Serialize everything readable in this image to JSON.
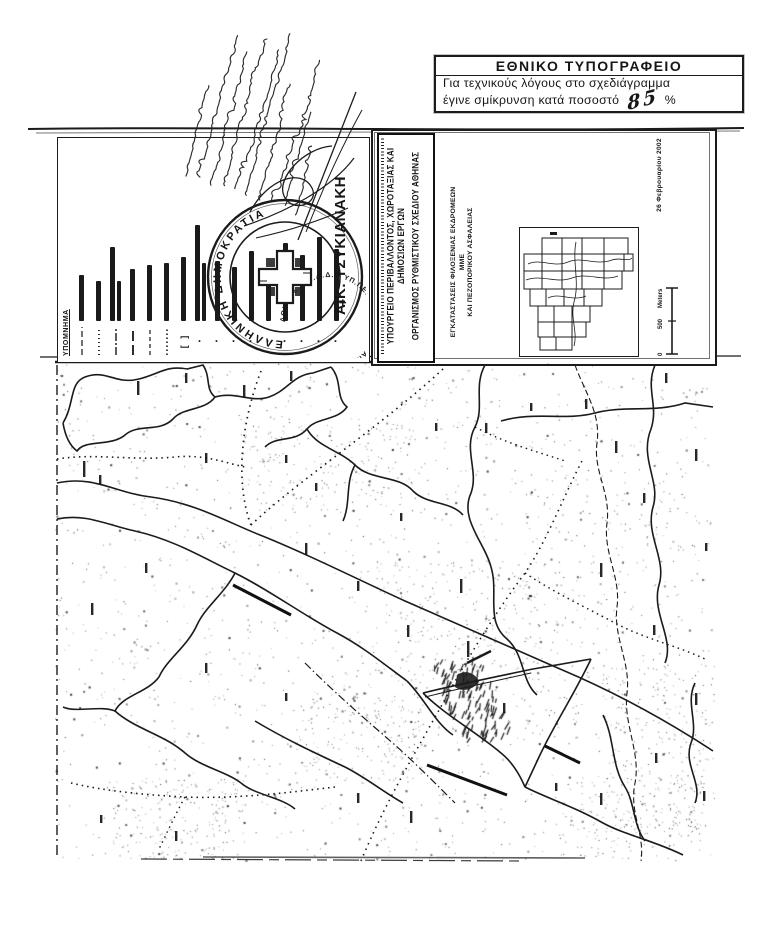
{
  "colors": {
    "ink": "#161616",
    "paper": "#ffffff"
  },
  "stamp": {
    "title": "ΕΘΝΙΚΟ ΤΥΠΟΓΡΑΦΕΙΟ",
    "body_line1": "Για τεχνικούς λόγους στο σχεδιάγραμμα",
    "body_line2": "έγινε σμίκρυνση κατά ποσοστό",
    "percent": "85",
    "percent_unit": "%"
  },
  "legend": {
    "title": "ΥΠΟΜΝΗΜΑ",
    "bullet_char": "•",
    "bracket": "[  ]",
    "items": [
      {
        "type": "dash",
        "dash": "6 3",
        "w": 1.2,
        "bars": [
          46
        ]
      },
      {
        "type": "dash",
        "dash": "1 3",
        "w": 1.8,
        "bars": [
          40
        ]
      },
      {
        "type": "dash",
        "dash": "8 2 2 2",
        "w": 1.4,
        "bars": [
          74,
          40
        ]
      },
      {
        "type": "dash",
        "dash": "10 4",
        "w": 1.8,
        "bars": [
          52
        ]
      },
      {
        "type": "dash",
        "dash": "4 3",
        "w": 1.2,
        "bars": [
          56
        ]
      },
      {
        "type": "dash",
        "dash": "1.5 2.5",
        "w": 1.6,
        "bars": [
          58
        ]
      },
      {
        "type": "bracket",
        "bars": [
          64
        ]
      },
      {
        "type": "bullet",
        "bars": [
          96,
          58
        ]
      },
      {
        "type": "bullet",
        "bars": [
          60
        ]
      },
      {
        "type": "bullet",
        "bars": [
          54
        ]
      },
      {
        "type": "bullet",
        "bars": [
          70
        ]
      },
      {
        "type": "bullet",
        "bars": [
          44
        ]
      },
      {
        "type": "bullet",
        "bars": [
          78
        ]
      },
      {
        "type": "bullet",
        "bars": [
          66
        ]
      },
      {
        "type": "bullet",
        "bars": [
          84
        ]
      },
      {
        "type": "bullet",
        "bars": [
          72
        ]
      }
    ]
  },
  "seal": {
    "outer_text": "ΕΛΛΗΝΙΚΗ ΔΗΜΟΚΡΑΤΙΑ",
    "inner_text": "ΑΘΗΝΑΣ Ν.Π.Δ.Δ. • ΥΠ.ΠΕ.ΧΩ.Δ.Ε. • ΟΡΓΑΝΙΣΜΟΣ"
  },
  "signatory": {
    "name": "ΑΙΚ. ΤΣΥΚΙΑΝΑΚΗ",
    "mark": "+"
  },
  "title_block": {
    "ministry_line1": "ΥΠΟΥΡΓΕΙΟ ΠΕΡΙΒΑΛΛΟΝΤΟΣ, ΧΩΡΟΤΑΞΙΑΣ ΚΑΙ ΔΗΜΟΣΙΩΝ ΕΡΓΩΝ",
    "ministry_line2": "ΟΡΓΑΝΙΣΜΟΣ ΡΥΘΜΙΣΤΙΚΟΥ ΣΧΕΔΙΟΥ ΑΘΗΝΑΣ",
    "project_line1": "ΕΓΚΑΤΑΣΤΑΣΕΙΣ ΦΙΛΟΞΕΝΙΑΣ ΕΚΔΡΟΜΕΩΝ ΜΜΕ",
    "project_line2": "ΚΑΙ ΠΕΖΟΠΟΡΙΚΟΥ ΑΣΦΑΛΕΙΑΣ",
    "date": "26 Φεβρουαρίου 2002",
    "scale": {
      "zero": "0",
      "mid": "500",
      "unit": "Meters"
    }
  },
  "index_map": {
    "tiles": [
      [
        22,
        10,
        20,
        16
      ],
      [
        42,
        10,
        20,
        16
      ],
      [
        62,
        10,
        22,
        16
      ],
      [
        84,
        10,
        24,
        16
      ],
      [
        4,
        26,
        18,
        17
      ],
      [
        22,
        26,
        20,
        17
      ],
      [
        42,
        26,
        20,
        17
      ],
      [
        62,
        26,
        22,
        17
      ],
      [
        84,
        26,
        20,
        17
      ],
      [
        104,
        26,
        9,
        17
      ],
      [
        4,
        43,
        18,
        18
      ],
      [
        22,
        43,
        20,
        18
      ],
      [
        42,
        43,
        20,
        18
      ],
      [
        62,
        43,
        22,
        18
      ],
      [
        84,
        43,
        18,
        18
      ],
      [
        10,
        61,
        16,
        17
      ],
      [
        26,
        61,
        18,
        17
      ],
      [
        44,
        61,
        20,
        17
      ],
      [
        64,
        61,
        18,
        17
      ],
      [
        18,
        78,
        16,
        16
      ],
      [
        34,
        78,
        18,
        16
      ],
      [
        52,
        78,
        18,
        16
      ],
      [
        18,
        94,
        16,
        15
      ],
      [
        34,
        94,
        18,
        15
      ],
      [
        52,
        94,
        14,
        15
      ],
      [
        20,
        109,
        16,
        13
      ],
      [
        36,
        109,
        16,
        13
      ]
    ]
  },
  "map": {
    "label_marks": [
      [
        82,
        18,
        14
      ],
      [
        130,
        10,
        10
      ],
      [
        188,
        22,
        12
      ],
      [
        235,
        8,
        10
      ],
      [
        28,
        98,
        16
      ],
      [
        44,
        112,
        10
      ],
      [
        150,
        90,
        10
      ],
      [
        230,
        92,
        8
      ],
      [
        250,
        180,
        12
      ],
      [
        302,
        218,
        10
      ],
      [
        352,
        262,
        12
      ],
      [
        405,
        216,
        14
      ],
      [
        430,
        60,
        10
      ],
      [
        475,
        40,
        8
      ],
      [
        530,
        36,
        10
      ],
      [
        560,
        78,
        12
      ],
      [
        610,
        10,
        10
      ],
      [
        640,
        86,
        12
      ],
      [
        588,
        130,
        10
      ],
      [
        650,
        180,
        8
      ],
      [
        545,
        200,
        14
      ],
      [
        598,
        262,
        10
      ],
      [
        640,
        330,
        12
      ],
      [
        600,
        390,
        10
      ],
      [
        648,
        428,
        10
      ],
      [
        545,
        430,
        12
      ],
      [
        500,
        420,
        8
      ],
      [
        302,
        430,
        10
      ],
      [
        355,
        448,
        12
      ],
      [
        120,
        468,
        10
      ],
      [
        45,
        452,
        8
      ],
      [
        260,
        120,
        8
      ],
      [
        345,
        150,
        8
      ],
      [
        412,
        278,
        16
      ],
      [
        448,
        340,
        10
      ],
      [
        380,
        60,
        8
      ],
      [
        90,
        200,
        10
      ],
      [
        36,
        240,
        12
      ],
      [
        150,
        300,
        10
      ],
      [
        230,
        330,
        8
      ]
    ]
  }
}
